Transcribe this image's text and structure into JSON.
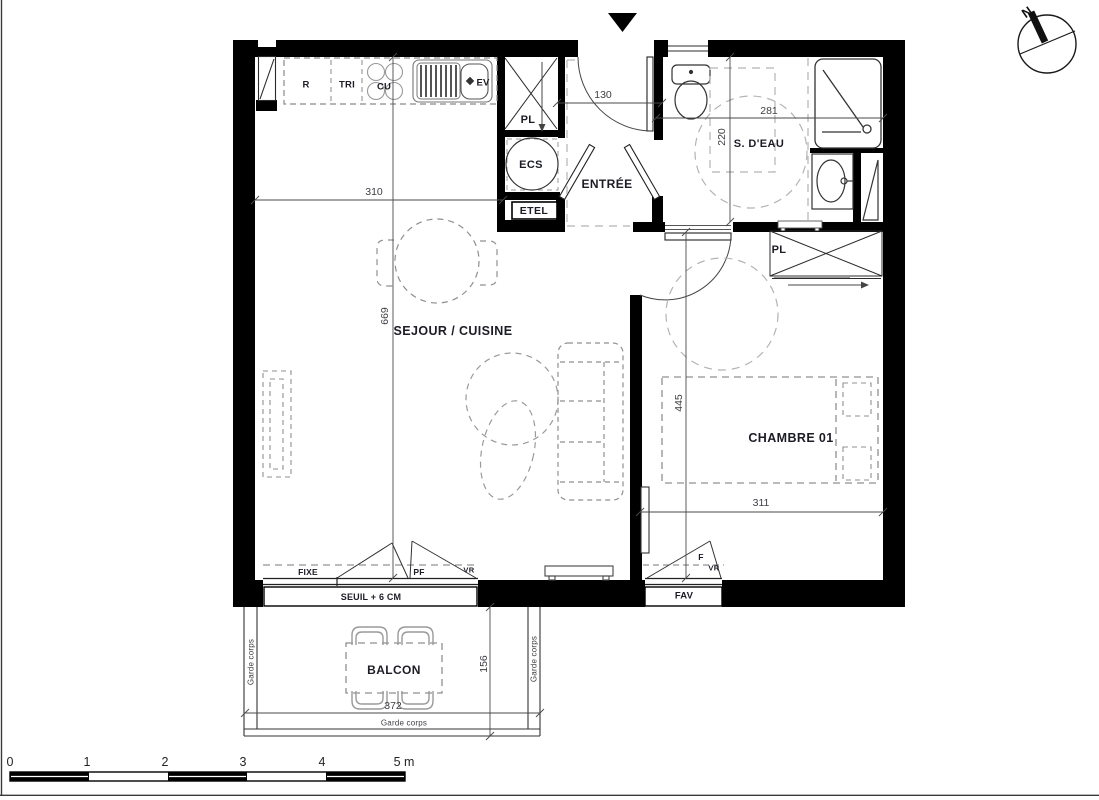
{
  "rooms": {
    "living": "SEJOUR / CUISINE",
    "entry": "ENTRÉE",
    "bathroom": "S. D'EAU",
    "bedroom": "CHAMBRE 01",
    "balcony": "BALCON"
  },
  "equipment": {
    "fridge": "R",
    "waste": "TRI",
    "hob": "CU",
    "sink": "EV",
    "entry_closet": "PL",
    "water_heater": "ECS",
    "electrical_panel": "ETEL",
    "bedroom_closet": "PL"
  },
  "openings": {
    "fixed_pane": "FIXE",
    "french_window": "PF",
    "roller_shutter_living": "VR",
    "threshold": "SEUIL + 6 CM",
    "bedroom_shutter_unit": "FAV",
    "window": "F",
    "roller_shutter_bedroom": "VR"
  },
  "railings": {
    "left": "Garde corps",
    "right": "Garde corps",
    "front": "Garde corps"
  },
  "dimensions_cm": {
    "kitchen_width": "310",
    "living_depth": "669",
    "entry_width": "130",
    "bathroom_width": "281",
    "bathroom_depth": "220",
    "bedroom_depth": "445",
    "bedroom_width": "311",
    "balcony_width": "372",
    "balcony_depth": "156"
  },
  "scale_bar": {
    "t0": "0",
    "t1": "1",
    "t2": "2",
    "t3": "3",
    "t4": "4",
    "t5": "5 m"
  },
  "compass": {
    "north": "N"
  },
  "colors": {
    "wall": "#000000",
    "fixture_line": "#3a3a3a",
    "furniture_dash": "#8f8f8f",
    "accessibility_dash": "#b3b3b3",
    "label_text": "#1c1c26",
    "dim_text": "#3e3e44"
  }
}
